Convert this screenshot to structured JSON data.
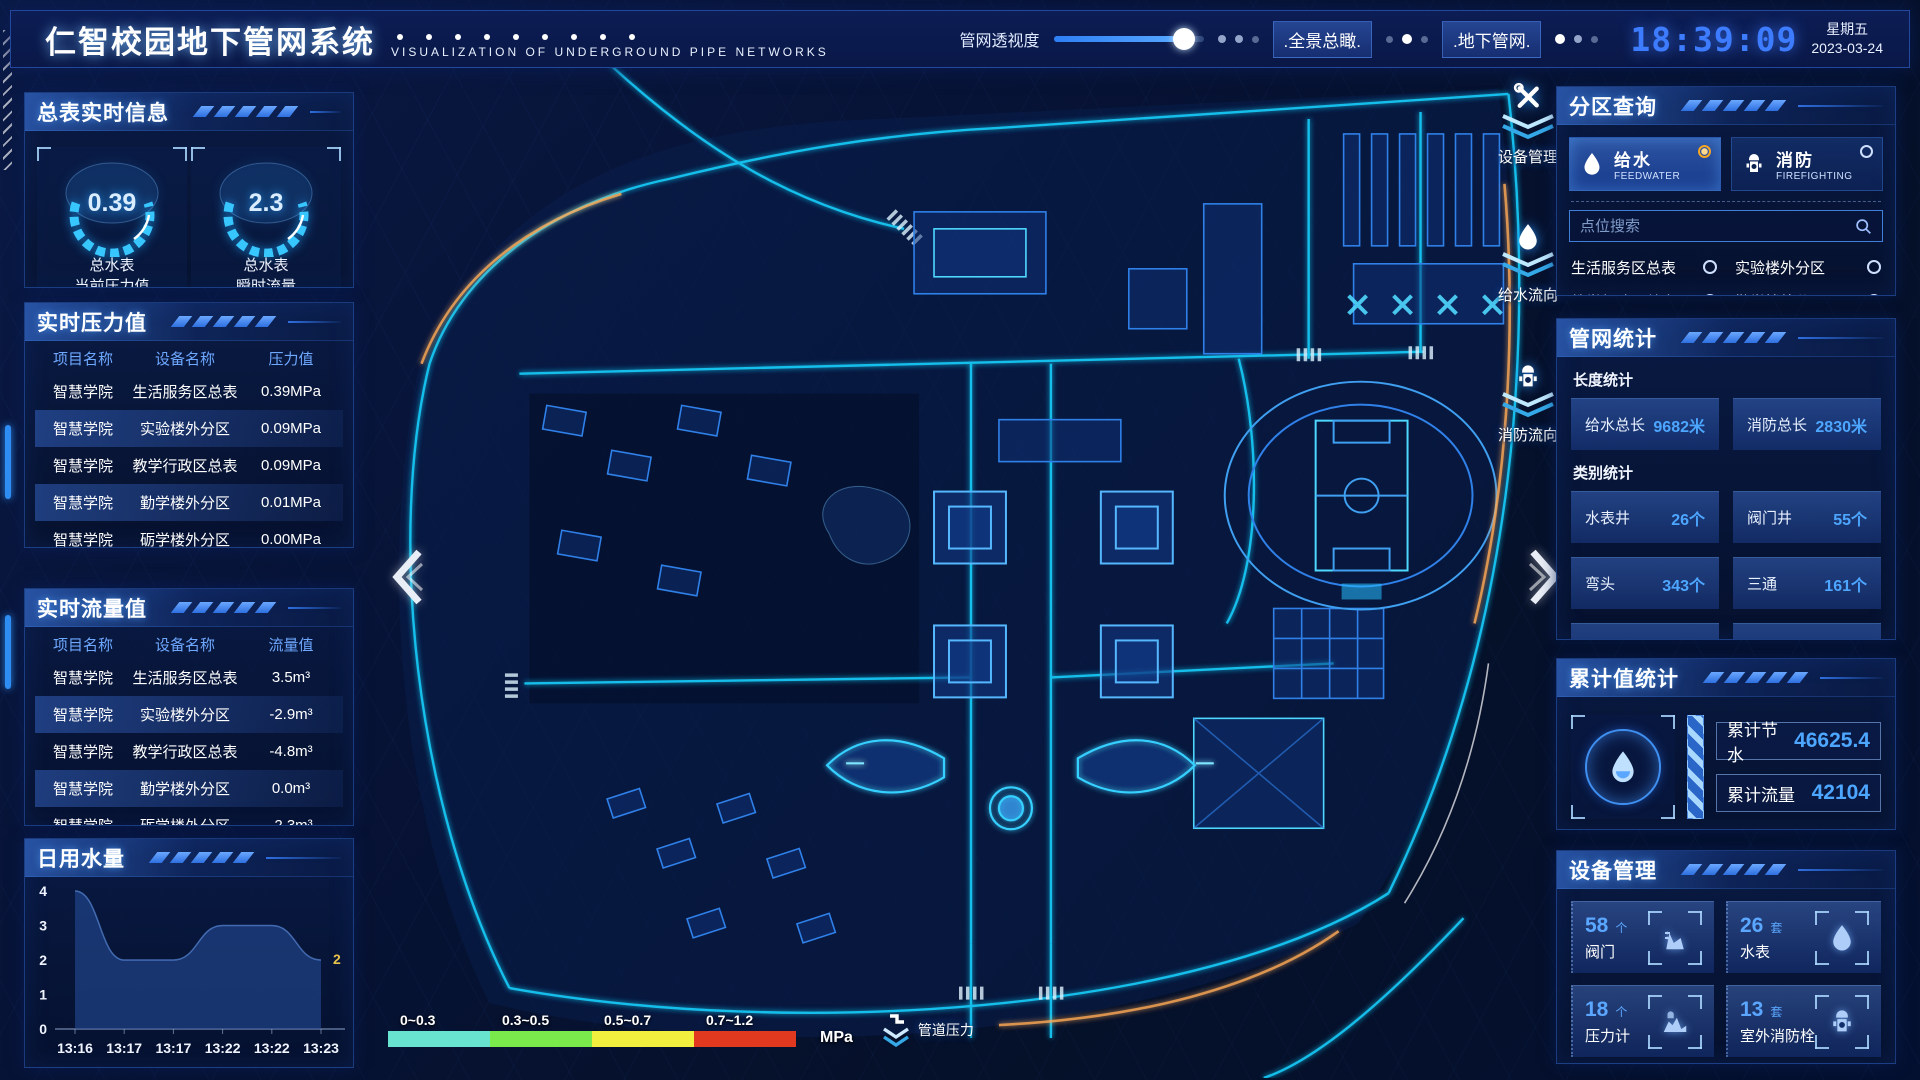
{
  "header": {
    "title": "仁智校园地下管网系统",
    "subtitle": "VISUALIZATION OF UNDERGROUND PIPE NETWORKS",
    "opacity_label": "管网透视度",
    "btn_overview": ".全景总瞰.",
    "btn_underground": ".地下管网.",
    "clock": "18:39:09",
    "weekday": "星期五",
    "date": "2023-03-24"
  },
  "left": {
    "meters": {
      "title": "总表实时信息",
      "gauges": [
        {
          "value": "0.39",
          "line1": "总水表",
          "line2": "当前压力值"
        },
        {
          "value": "2.3",
          "line1": "总水表",
          "line2": "瞬时流量"
        }
      ]
    },
    "pressure": {
      "title": "实时压力值",
      "headers": [
        "项目名称",
        "设备名称",
        "压力值"
      ],
      "rows": [
        [
          "智慧学院",
          "生活服务区总表",
          "0.39MPa"
        ],
        [
          "智慧学院",
          "实验楼外分区",
          "0.09MPa"
        ],
        [
          "智慧学院",
          "教学行政区总表",
          "0.09MPa"
        ],
        [
          "智慧学院",
          "勤学楼外分区",
          "0.01MPa"
        ],
        [
          "智慧学院",
          "砺学楼外分区",
          "0.00MPa"
        ]
      ]
    },
    "flow": {
      "title": "实时流量值",
      "headers": [
        "项目名称",
        "设备名称",
        "流量值"
      ],
      "rows": [
        [
          "智慧学院",
          "生活服务区总表",
          "3.5m³"
        ],
        [
          "智慧学院",
          "实验楼外分区",
          "-2.9m³"
        ],
        [
          "智慧学院",
          "教学行政区总表",
          "-4.8m³"
        ],
        [
          "智慧学院",
          "勤学楼外分区",
          "0.0m³"
        ],
        [
          "智慧学院",
          "砺学楼外分区",
          "-2.3m³"
        ]
      ]
    },
    "daily": {
      "title": "日用水量",
      "chart_data": {
        "type": "area",
        "x": [
          "13:16",
          "13:17",
          "13:17",
          "13:22",
          "13:22",
          "13:23"
        ],
        "values": [
          4,
          2,
          2,
          3,
          3,
          2
        ],
        "ylim": [
          0,
          4
        ],
        "yticks": [
          0,
          1,
          2,
          3,
          4
        ],
        "end_label": "2",
        "end_label_color": "#e8c34a",
        "area_color": "rgba(38,80,158,0.55)"
      }
    }
  },
  "right": {
    "zone": {
      "title": "分区查询",
      "tabs": [
        {
          "label": "给水",
          "sub": "FEEDWATER",
          "selected": true
        },
        {
          "label": "消防",
          "sub": "FIREFIGHTING",
          "selected": false
        }
      ],
      "search_placeholder": "点位搜索",
      "items": [
        "生活服务区总表",
        "实验楼外分区",
        "教学行政区总表",
        "勤学楼外分区",
        "砺学楼外分区",
        "宿舍区泵房"
      ]
    },
    "stats": {
      "title": "管网统计",
      "length_label": "长度统计",
      "length_cards": [
        {
          "label": "给水总长",
          "value": "9682米"
        },
        {
          "label": "消防总长",
          "value": "2830米"
        }
      ],
      "category_label": "类别统计",
      "category_cards": [
        {
          "label": "水表井",
          "value": "26个"
        },
        {
          "label": "阀门井",
          "value": "55个"
        },
        {
          "label": "弯头",
          "value": "343个"
        },
        {
          "label": "三通",
          "value": "161个"
        }
      ]
    },
    "totals": {
      "title": "累计值统计",
      "rows": [
        {
          "label": "累计节水",
          "value": "46625.4"
        },
        {
          "label": "累计流量",
          "value": "42104"
        }
      ]
    },
    "devices": {
      "title": "设备管理",
      "cards": [
        {
          "count": "58",
          "unit": "个",
          "name": "阀门",
          "icon": "valve-icon"
        },
        {
          "count": "26",
          "unit": "套",
          "name": "水表",
          "icon": "water-meter-icon"
        },
        {
          "count": "18",
          "unit": "个",
          "name": "压力计",
          "icon": "pressure-gauge-icon"
        },
        {
          "count": "13",
          "unit": "套",
          "name": "室外消防栓",
          "icon": "hydrant-icon"
        }
      ]
    }
  },
  "map": {
    "nav_buttons": [
      {
        "label": "设备管理",
        "icon": "tools-icon"
      },
      {
        "label": "给水流向",
        "icon": "water-drop-icon"
      },
      {
        "label": "消防流向",
        "icon": "hydrant-icon"
      }
    ],
    "legend": {
      "ranges": [
        "0~0.3",
        "0.3~0.5",
        "0.5~0.7",
        "0.7~1.2"
      ],
      "colors": [
        "#67e3cf",
        "#79e94c",
        "#f2ef3f",
        "#e0391f"
      ],
      "unit": "MPa",
      "label": "管道压力"
    }
  },
  "colors": {
    "accent": "#2f7ff5",
    "value_blue": "#4da6ff",
    "glow_cyan": "#19d3ff",
    "clock_blue": "#3d7bff",
    "selected_radio": "#f5a623"
  }
}
